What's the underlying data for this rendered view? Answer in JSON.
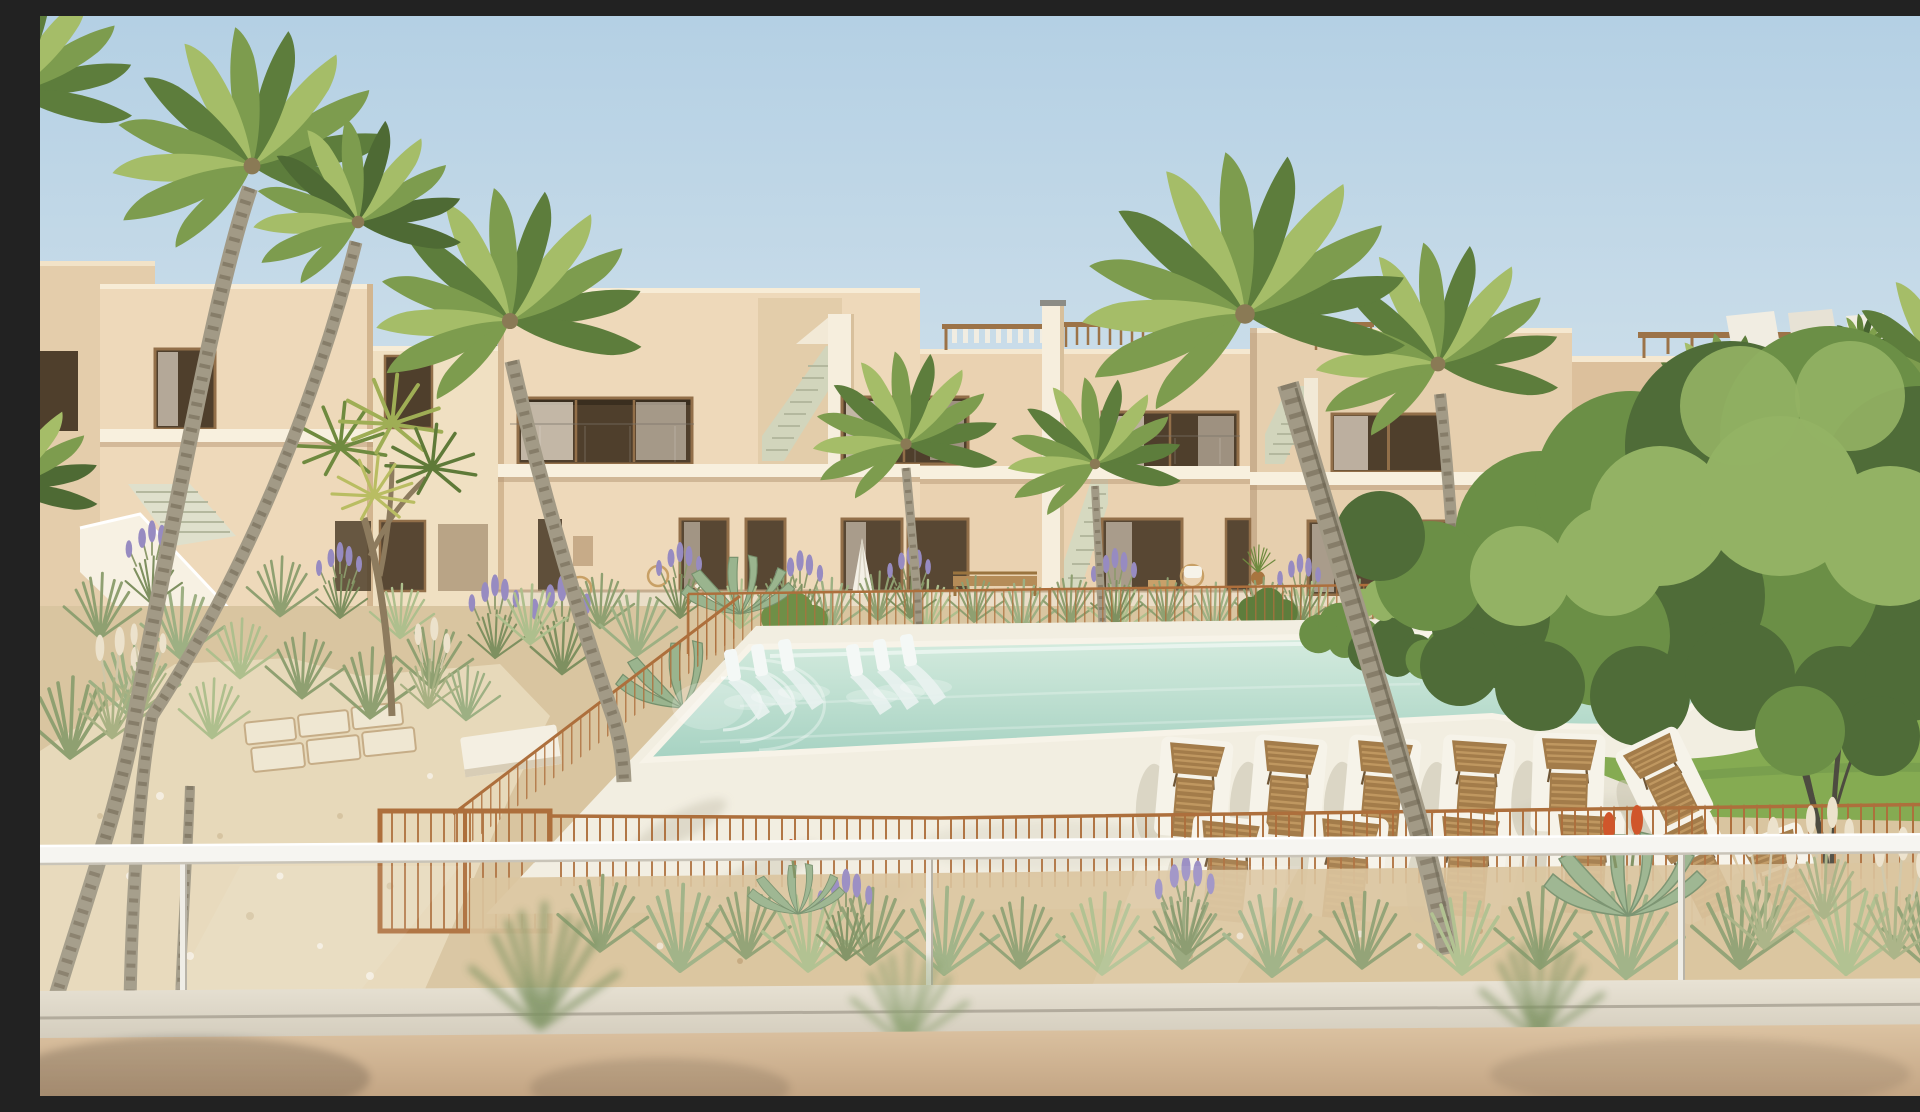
{
  "scene": {
    "type": "architectural-visualization",
    "description": "Photorealistic 3D rendering of a modern Mediterranean apartment complex: beige two-storey townhouses with recessed balconies, roof pergolas and external staircases surround a landscaped courtyard. A free-form communal pool with white in-water loungers sits on a white stone deck with rows of wooden sunbeds behind a thin corten-steel wire fence. Desert-style planting (ornamental grasses, lavender, agave, pampas plumes), palm trees and a large leafy green tree on a lawn to the right. The view is from a first-floor balcony over a white handrail and glass balustrade with a warm beige parapet wall at the bottom.",
    "time_of_day": "bright sunny daylight, clear sky",
    "camera": "elevated balcony viewpoint looking across the pool courtyard",
    "counts": {
      "wooden_sunbeds": 12,
      "in_pool_loungers": 6,
      "palm_canopies": 10,
      "roof_pergolas": 6,
      "external_staircases": 5
    },
    "regions": {
      "sky": "clear pale blue gradient sky",
      "left_building": "tall beige block with white staircase parapet and dark window recesses",
      "center_building": "long two-storey facade, dark glazed openings, white balcony slabs, two stair gaps, roof pergolas",
      "right_building": "further beige block with stair and pergola, partly hidden by trees",
      "far_right_building": "block with timber pergola and white louvre screens on the roof terrace",
      "pool": "free-form pool, pale turquoise water, rounded right lobe, white coping",
      "pool_steps": "curved white entry steps at the left end of the pool",
      "in_pool_loungers": "two groups of three white submerged chaise loungers",
      "deck": "white stone sun deck with soft palm shadows",
      "sunbeds": "slatted timber sunbeds on white pads, two rows plus a cluster by the lawn",
      "lawn": "bright green lawn wrapping the pool's right lobe",
      "large_tree": "big leafy deciduous tree with multi-stem trunk on the right",
      "palms": "various palms and a multi-head cordyline across the courtyard",
      "garden": "sandy beds with ornamental grasses, lavender, agave and pampas plumes",
      "gravel_path": "light cobble path with square stepping stones on the left",
      "pool_fence": "thin rust corten wire fence around the pool deck with a double gate",
      "balustrade": "foreground white handrail, clear glass panels with posts",
      "parapet_wall": "blurred warm beige wall and ledge at the bottom edge"
    }
  },
  "palette": {
    "skytop": "#b4d0e4",
    "skylow": "#e4ecef",
    "facade": "#eed9ba",
    "facadeshade": "#dcc09c",
    "facadedark": "#b89a78",
    "facadelit": "#f3e2c6",
    "opening": "#4f3f2c",
    "frame": "#926f49",
    "curtain": "#e0d6c6",
    "slab": "#f8f0de",
    "stair": "#d2d5bc",
    "stairline": "#b4b89e",
    "pergola": "#9c7348",
    "pergolawhite": "#f1ede2",
    "sand": "#d9c5a0",
    "path": "#e7d9ba",
    "deck": "#f2eee1",
    "deckshadow": "#cdc9b6",
    "water1": "#d6ecdf",
    "water2": "#a6d2c2",
    "lawn": "#85ab52",
    "lawnlight": "#a3c26d",
    "treedark": "#4f6c38",
    "treemid": "#6b8f46",
    "treelight": "#93b264",
    "palmdark": "#5d7d3c",
    "palmmid": "#7d9c4e",
    "palmlight": "#a5bd68",
    "trunk": "#a29a86",
    "trunkdash": "#867d69",
    "fence": "#ad6f3c",
    "wood": "#a37c4a",
    "woodlight": "#bf9760",
    "pad": "#f6f3e9",
    "rail": "#f6f5f1",
    "ledge1": "#e9e3d5",
    "ledge2": "#cfc8b8",
    "wall1": "#dcc3a2",
    "wall2": "#c3a584",
    "lavender": "#978bc1",
    "plume": "#ece2cc",
    "aloered": "#d0562b"
  }
}
